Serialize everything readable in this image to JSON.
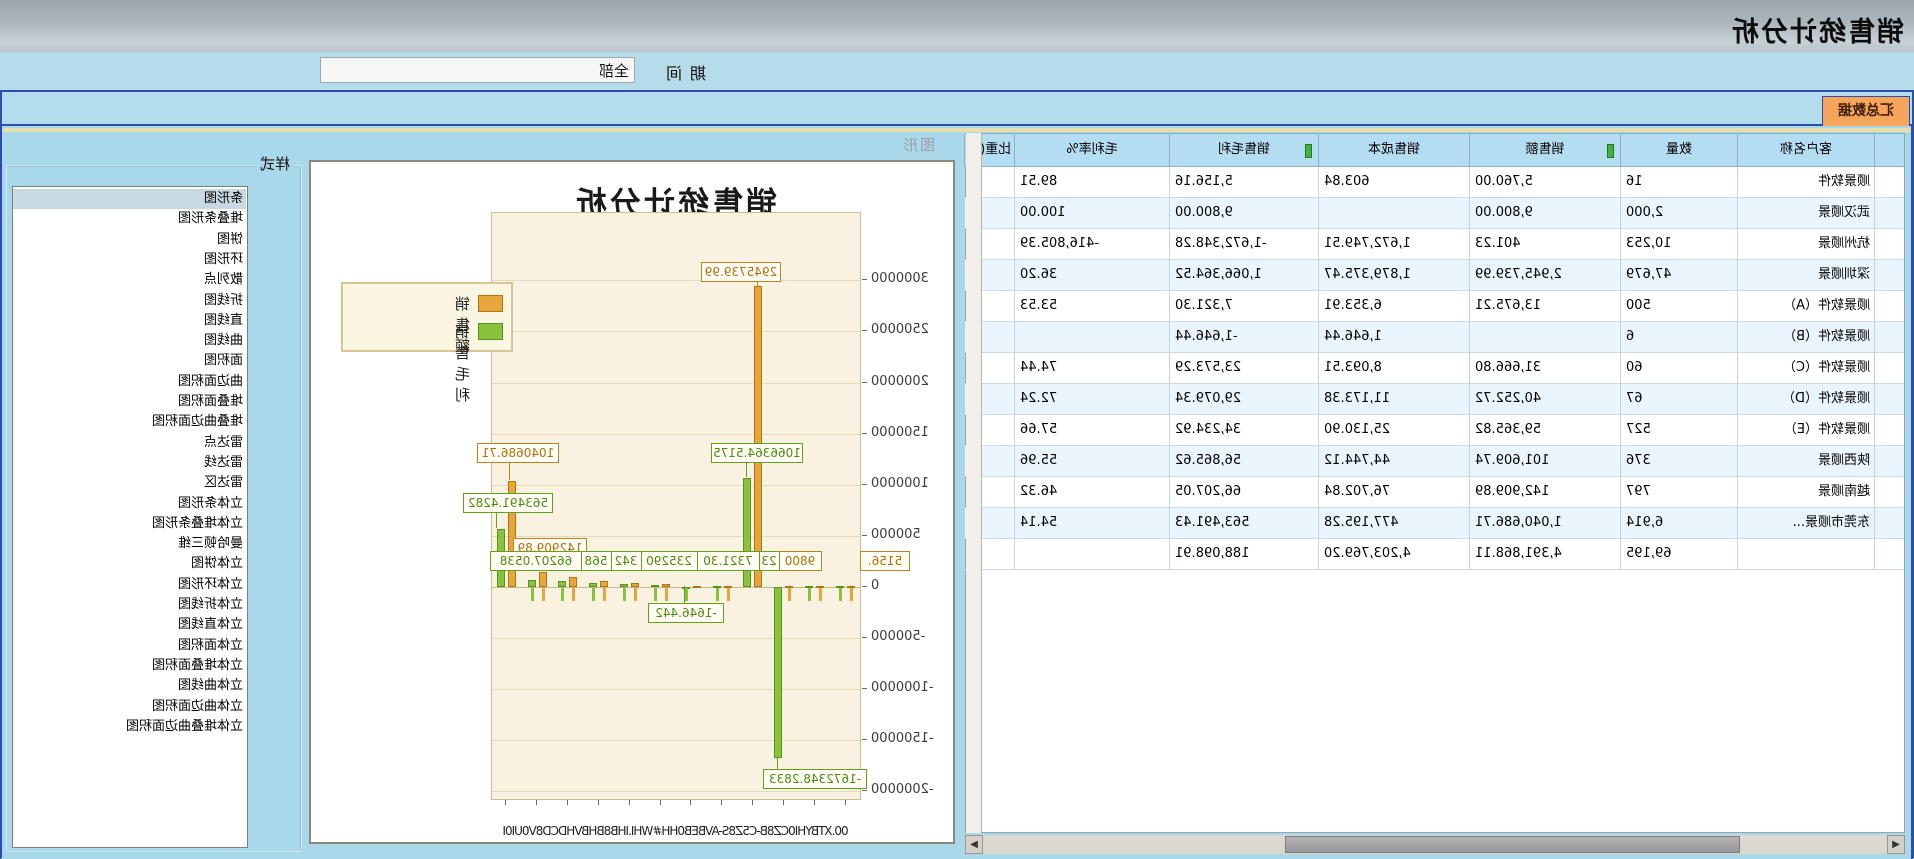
{
  "window": {
    "title": "销售统计分析"
  },
  "toolbar": {
    "period_label": "期间",
    "period_value": "全部"
  },
  "tabs": {
    "summary": "汇总数据"
  },
  "labels": {
    "chart_area": "图形",
    "style_group": "样式"
  },
  "table": {
    "headers": [
      "",
      "客户名称",
      "数量",
      "销售额",
      "销售成本",
      "销售毛利",
      "毛利率%",
      "比重(%"
    ],
    "sorted_columns": [
      "销售额",
      "销售毛利"
    ],
    "rows": [
      [
        "",
        "顺景软件",
        "16",
        "5,760.00",
        "603.84",
        "5,156.16",
        "89.51",
        ""
      ],
      [
        "",
        "武汉顺景",
        "2,000",
        "9,800.00",
        "",
        "9,800.00",
        "100.00",
        ""
      ],
      [
        "",
        "杭州顺景",
        "10,253",
        "401.23",
        "1,672,749.51",
        "-1,672,348.28",
        "-416,805.39",
        ""
      ],
      [
        "",
        "深圳顺景",
        "47,679",
        "2,945,739.99",
        "1,879,375.47",
        "1,066,364.52",
        "36.20",
        ""
      ],
      [
        "",
        "顺景软件（A）",
        "500",
        "13,675.21",
        "6,353.91",
        "7,321.30",
        "53.53",
        ""
      ],
      [
        "",
        "顺景软件（B）",
        "6",
        "",
        "1,646.44",
        "-1,646.44",
        "",
        ""
      ],
      [
        "",
        "顺景软件（C）",
        "60",
        "31,666.80",
        "8,093.51",
        "23,573.29",
        "74.44",
        ""
      ],
      [
        "",
        "顺景软件（D）",
        "67",
        "40,252.72",
        "11,173.38",
        "29,079.34",
        "72.24",
        ""
      ],
      [
        "",
        "顺景软件（E）",
        "527",
        "59,365.82",
        "25,130.90",
        "34,234.92",
        "57.66",
        ""
      ],
      [
        "",
        "陕西顺景",
        "376",
        "101,609.74",
        "44,744.12",
        "56,865.62",
        "55.96",
        ""
      ],
      [
        "",
        "越南顺景",
        "797",
        "142,909.89",
        "76,702.84",
        "66,207.05",
        "46.32",
        ""
      ],
      [
        "",
        "东莞市顺景...",
        "6,914",
        "1,040,686.71",
        "477,195.28",
        "563,491.43",
        "54.14",
        ""
      ],
      [
        "",
        "",
        "69,195",
        "4,391,868.11",
        "4,203,769.20",
        "188,098.91",
        "",
        ""
      ]
    ]
  },
  "style_list": {
    "selected": "条形图",
    "items": [
      "条形图",
      "堆叠条形图",
      "饼图",
      "环形图",
      "散列点",
      "折线图",
      "直线图",
      "曲线图",
      "面积图",
      "曲边面积图",
      "堆叠面积图",
      "堆叠曲边面积图",
      "雷达点",
      "雷达线",
      "雷达区",
      "立体条形图",
      "立体堆叠条形图",
      "曼哈顿三维",
      "立体饼图",
      "立体环形图",
      "立体折线图",
      "立体直线图",
      "立体面积图",
      "立体堆叠面积图",
      "立体曲线图",
      "立体曲边面积图",
      "立体堆叠曲边面积图"
    ]
  },
  "chart_data": {
    "type": "bar",
    "title": "销售统计分析",
    "legend_position": "right",
    "grid": true,
    "ylim": [
      -2000000,
      3000000
    ],
    "ytick_step": 500000,
    "ytick_labels": [
      "3000000",
      "2500000",
      "2000000",
      "1500000",
      "1000000",
      "500000",
      "0",
      "-500000",
      "-1000000",
      "-1500000",
      "-2000000"
    ],
    "categories": [
      "顺景软件",
      "武汉顺景",
      "杭州顺景",
      "深圳顺景",
      "顺景软件（A）",
      "顺景软件（B）",
      "顺景软件（C）",
      "顺景软件（D）",
      "顺景软件（E）",
      "陕西顺景",
      "越南顺景",
      "东莞市顺景"
    ],
    "series": [
      {
        "name": "销售额",
        "color": "#e6a63c",
        "values": [
          5760,
          9800,
          401.23,
          2945739.99,
          13675.21,
          0,
          31666.8,
          40252.72,
          59365.82,
          101609.74,
          142909.89,
          1040686.71
        ]
      },
      {
        "name": "销售毛利",
        "color": "#8ac23d",
        "values": [
          5156.16,
          9800,
          -1672348.28,
          1066364.52,
          7321.3,
          -1646.44,
          23573.29,
          29079.34,
          34234.92,
          56865.62,
          66207.05,
          563491.43
        ]
      }
    ],
    "callouts": [
      {
        "text": "2945739.99",
        "series": "sales"
      },
      {
        "text": "1066364.5175",
        "series": "profit"
      },
      {
        "text": "1040686.71",
        "series": "sales"
      },
      {
        "text": "563491.4282",
        "series": "profit"
      },
      {
        "text": "142909.89",
        "series": "sales"
      },
      {
        "text": "5156.",
        "series": "sales"
      },
      {
        "text": "9800",
        "series": "sales"
      },
      {
        "text": "23",
        "series": "profit"
      },
      {
        "text": "7321.30",
        "series": "profit"
      },
      {
        "text": "235290",
        "series": "profit"
      },
      {
        "text": "342",
        "series": "profit"
      },
      {
        "text": "568",
        "series": "profit"
      },
      {
        "text": "66207.0538",
        "series": "profit"
      },
      {
        "text": "-1646.442",
        "series": "profit"
      },
      {
        "text": "-1672348.2833",
        "series": "profit"
      }
    ],
    "x_axis_garbled": "00.XTBYHI0CZ8B-C5Z8S-AVBEB0HH#WHI.IHB8BHBVHDCD8V0UI0I"
  }
}
